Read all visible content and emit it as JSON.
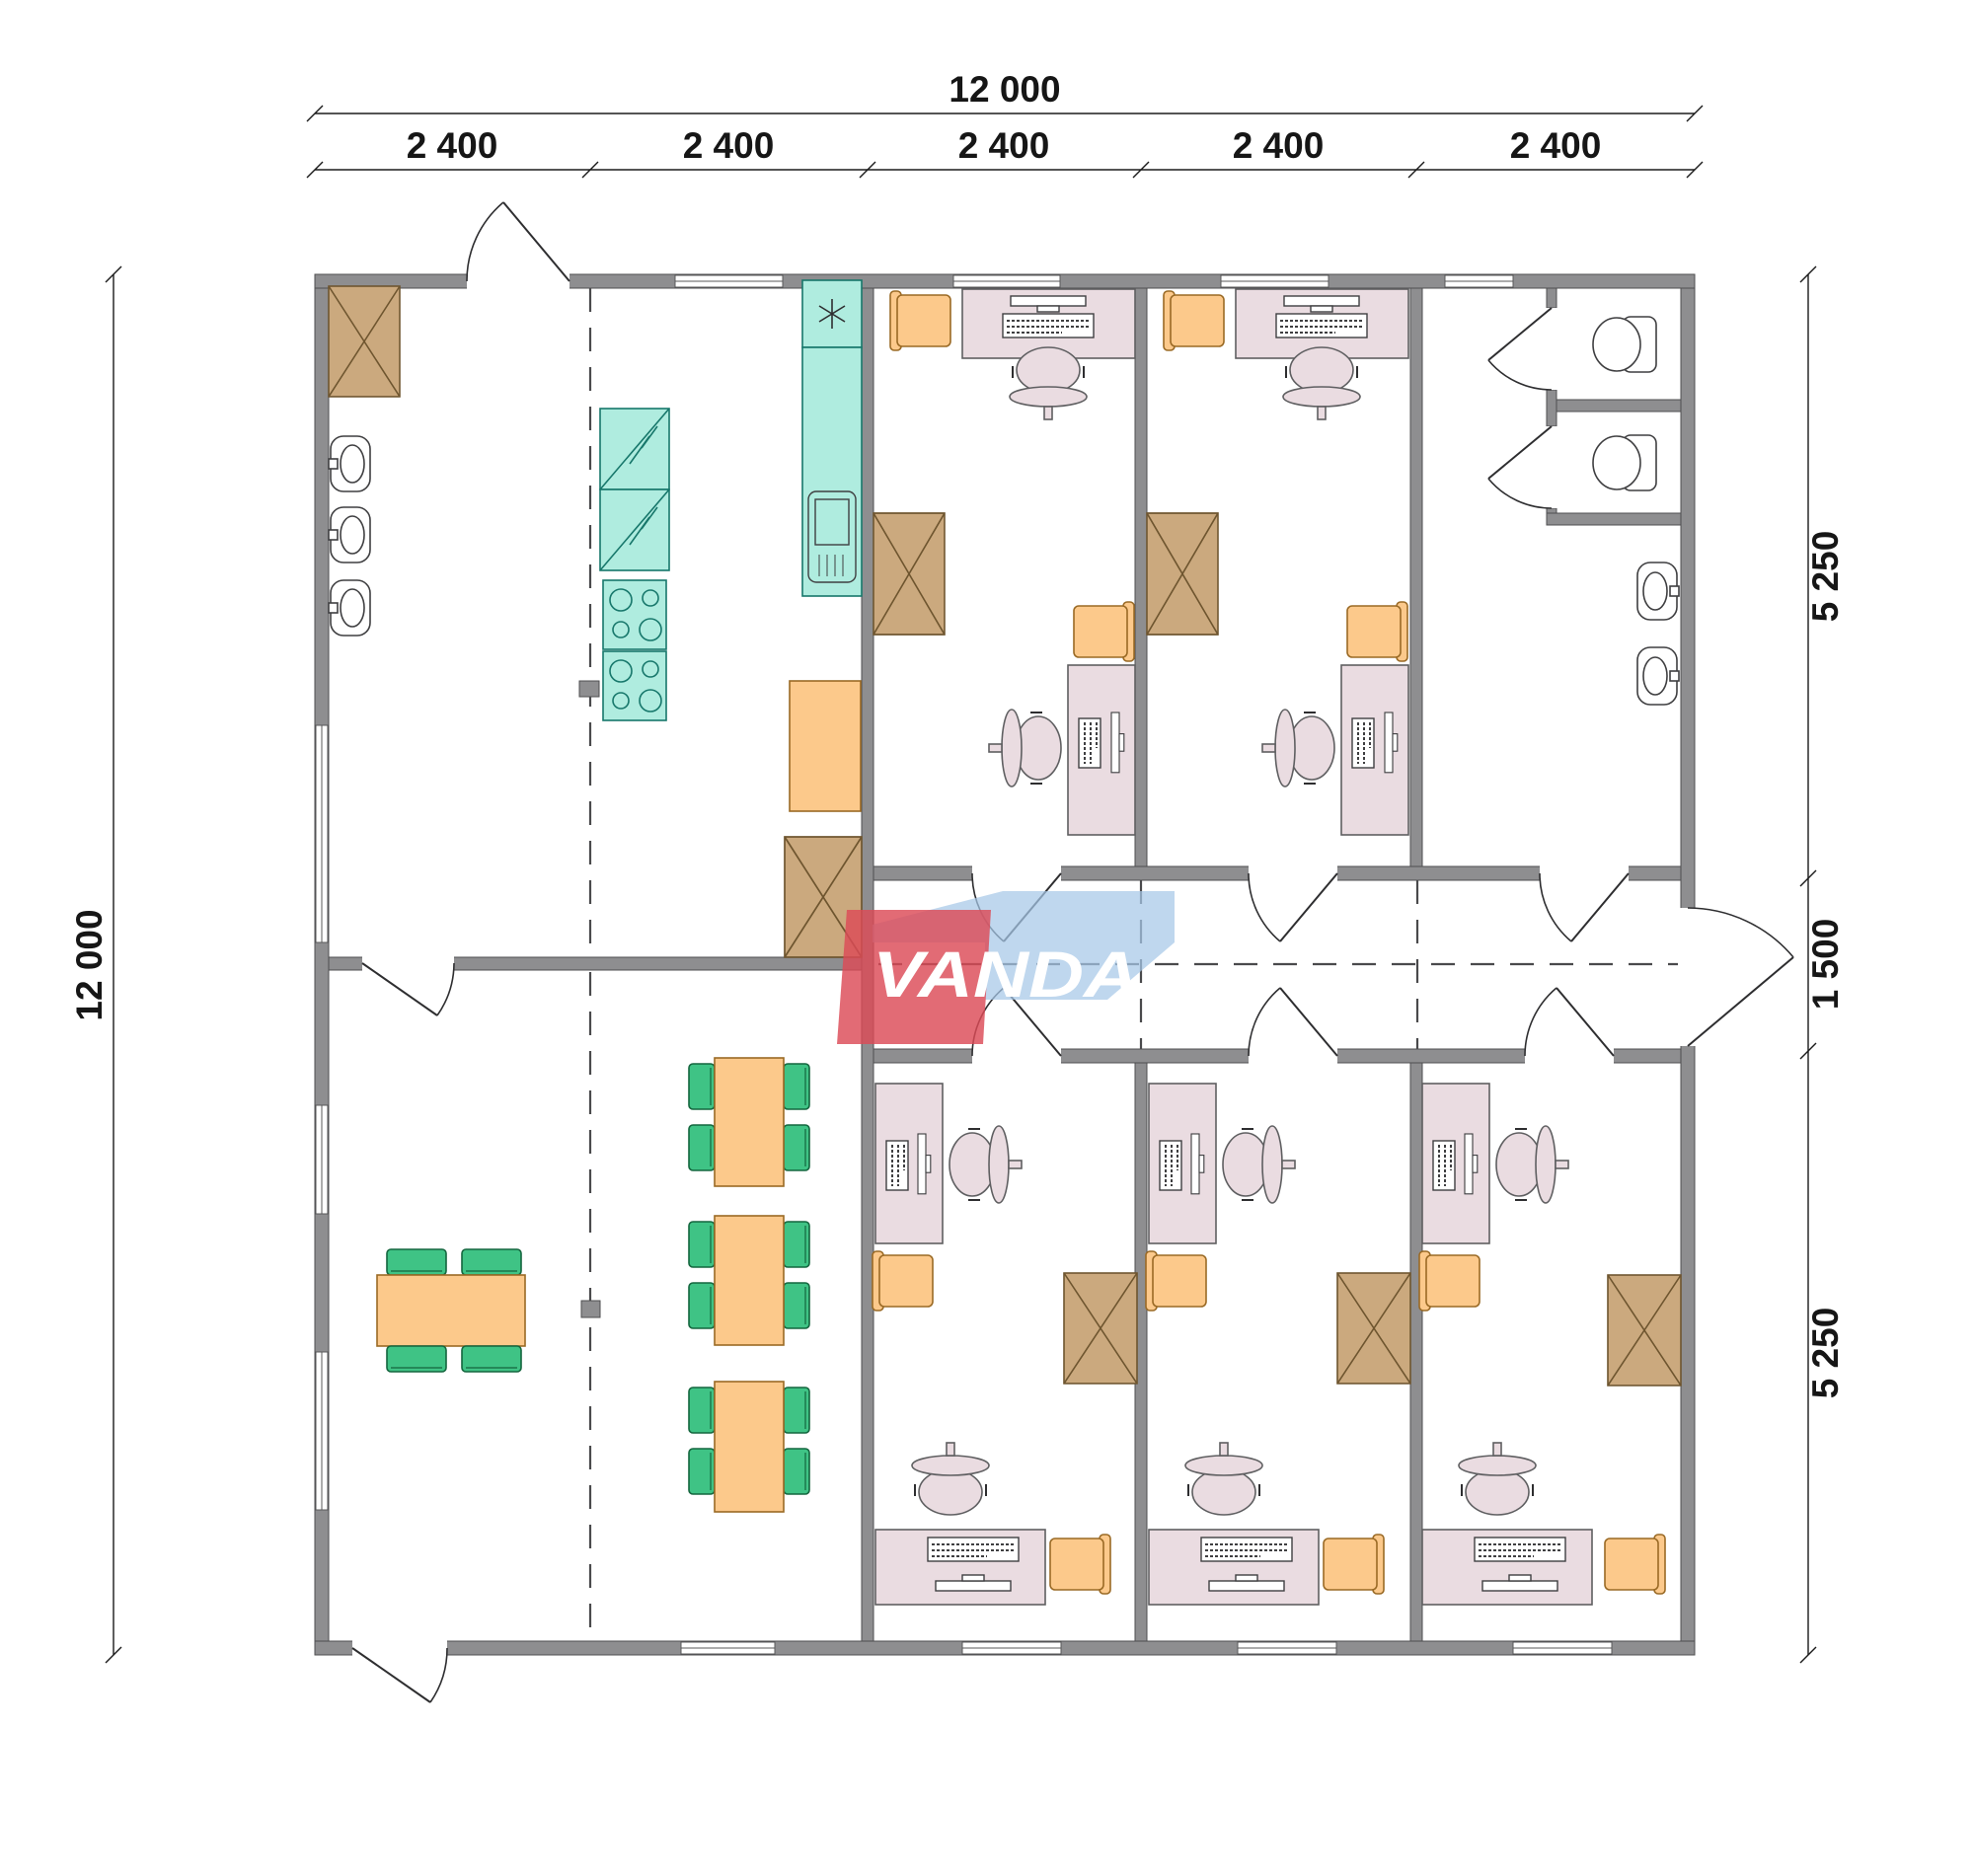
{
  "title": "Modular office container floor plan",
  "logo": {
    "text": "VANDA",
    "red": "#DC4B57",
    "blue": "#A6C8E8"
  },
  "dimensions": {
    "top_total": "12 000",
    "top_segments": [
      "2 400",
      "2 400",
      "2 400",
      "2 400",
      "2 400"
    ],
    "left_total": "12 000",
    "right_segments": [
      "5 250",
      "1 500",
      "5 250"
    ]
  },
  "plan": {
    "overall_width_mm": 12000,
    "overall_depth_mm": 12000,
    "module_width_mm": 2400,
    "module_count": 5,
    "right_zone_depths_mm": [
      5250,
      1500,
      5250
    ]
  },
  "colors": {
    "wall": "#8E8E90",
    "wall_outline": "#4F4F51",
    "cabinet_tan": "#CBA97E",
    "kitchen_teal": "#AFECDF",
    "furniture_orange": "#FCC98B",
    "chair_green": "#3FC385",
    "desk_pink": "#EADCE1",
    "logo_red": "#DC4B57",
    "logo_blue": "#A6C8E8"
  },
  "icons": [
    "crossed-cabinet-icon",
    "washbasin-icon",
    "toilet-icon",
    "fridge-icon",
    "stove-icon",
    "sink-asterisk-icon",
    "dishwasher-icon",
    "desk-computer-icon",
    "office-chair-icon",
    "door-swing-icon",
    "window-icon",
    "column-icon"
  ]
}
